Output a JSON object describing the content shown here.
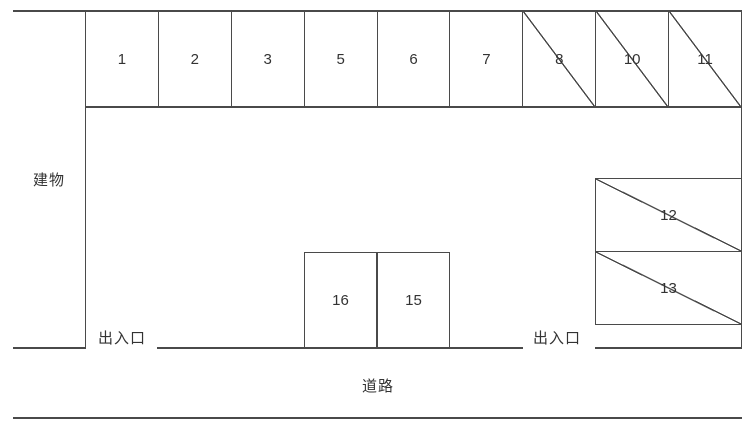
{
  "labels": {
    "building": "建物",
    "entrance_left": "出入口",
    "entrance_right": "出入口",
    "road": "道路"
  },
  "spaces": {
    "top_row": [
      {
        "number": "1",
        "crossed": false
      },
      {
        "number": "2",
        "crossed": false
      },
      {
        "number": "3",
        "crossed": false
      },
      {
        "number": "5",
        "crossed": false
      },
      {
        "number": "6",
        "crossed": false
      },
      {
        "number": "7",
        "crossed": false
      },
      {
        "number": "8",
        "crossed": true
      },
      {
        "number": "10",
        "crossed": true
      },
      {
        "number": "11",
        "crossed": true
      }
    ],
    "middle_row": [
      {
        "number": "16",
        "crossed": false
      },
      {
        "number": "15",
        "crossed": false
      }
    ],
    "right_column": [
      {
        "number": "12",
        "crossed": true
      },
      {
        "number": "13",
        "crossed": true
      }
    ]
  },
  "colors": {
    "line": "#4a4a4a",
    "text": "#333333",
    "background": "#ffffff"
  }
}
